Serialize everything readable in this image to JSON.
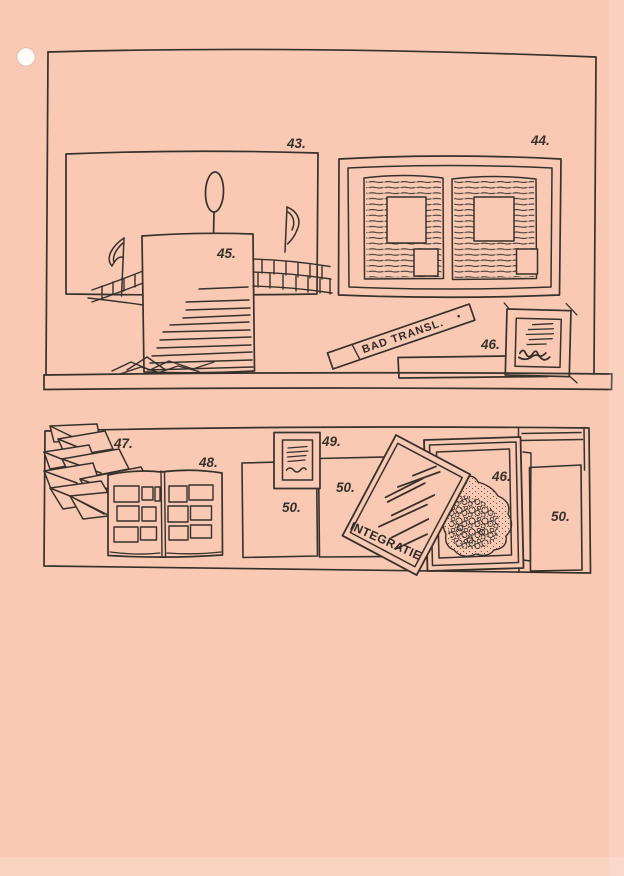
{
  "page": {
    "background_color": "#f9c9b3",
    "ink_color": "#36312b",
    "hole_icon": "punch-hole"
  },
  "top_shelf": {
    "mural_label": "43.",
    "diptych_label": "44.",
    "document_label": "45.",
    "framed_note_label": "46.",
    "sign_text": "BAD TRANSL."
  },
  "bottom_shelf": {
    "papers_label": "47.",
    "album_label": "48.",
    "small_frame_label": "49.",
    "panel_left_label": "50.",
    "panel_middle_label": "50.",
    "panel_right_label": "50.",
    "crumple_frame_label": "46.",
    "tilted_document_title": "INTEGRATIE"
  }
}
